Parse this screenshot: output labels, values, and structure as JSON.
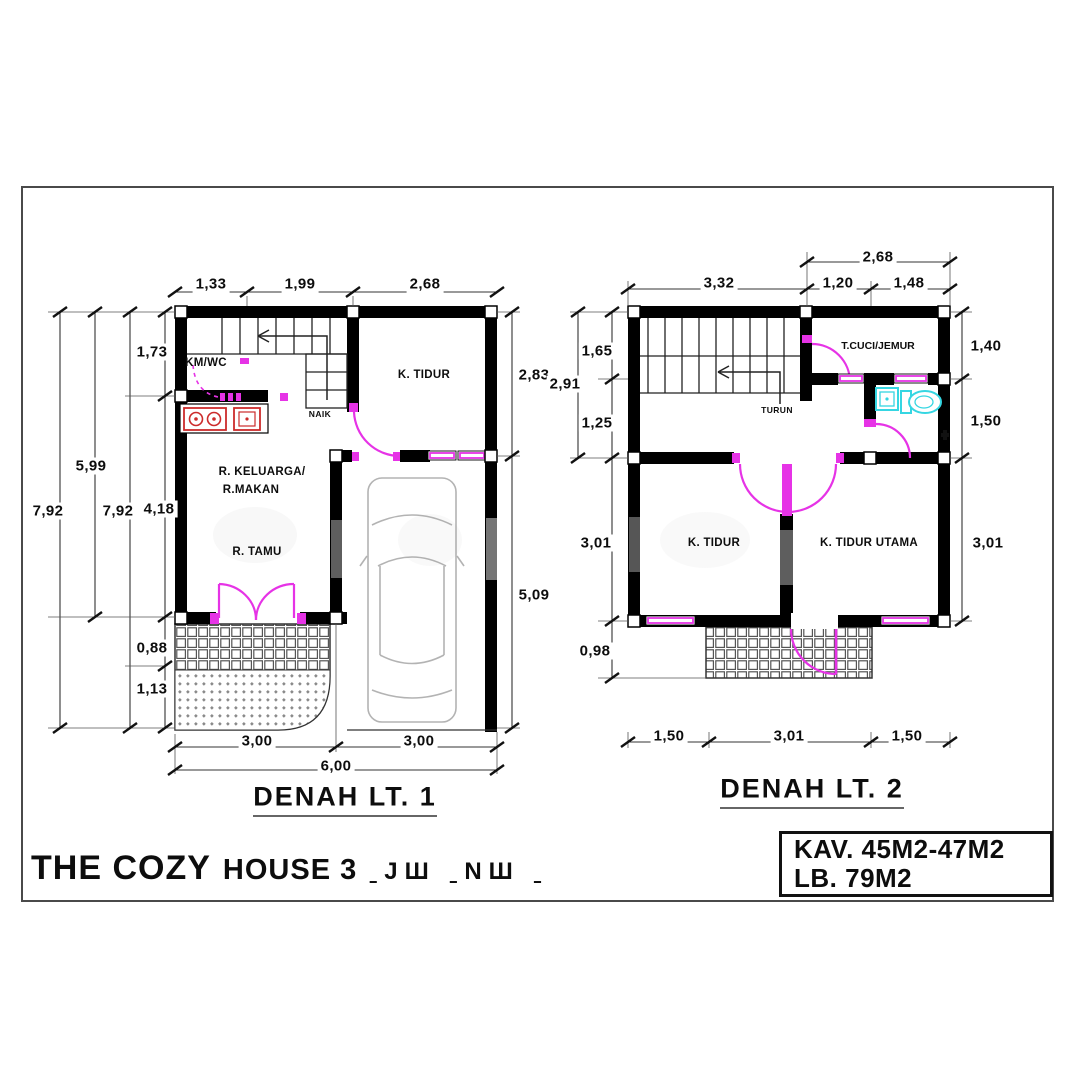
{
  "palette": {
    "wall": "#000000",
    "openings": "#e633e6",
    "sanitary": "#35d6e2",
    "kitchen": "#cc2b2b"
  },
  "plan1": {
    "title": "DENAH  LT. 1",
    "stair_direction": "NAIK",
    "rooms": {
      "kmwc": "KM/WC",
      "bedroom": "K. TIDUR",
      "family1": "R. KELUARGA/",
      "family2": "R.MAKAN",
      "living": "R. TAMU"
    },
    "dims": {
      "top": [
        "1,33",
        "1,99",
        "2,68"
      ],
      "left": [
        "1,73",
        "5,99",
        "7,92",
        "7,92",
        "4,18",
        "0,88",
        "1,13"
      ],
      "right": [
        "2,83",
        "5,09"
      ],
      "bottom": [
        "3,00",
        "3,00",
        "6,00"
      ]
    }
  },
  "plan2": {
    "title": "DENAH  LT. 2",
    "stair_direction": "TURUN",
    "rooms": {
      "laundry": "T.CUCI/JEMUR",
      "bedroom": "K. TIDUR",
      "master": "K. TIDUR UTAMA"
    },
    "dims": {
      "top": [
        "2,68",
        "3,32",
        "1,20",
        "1,48"
      ],
      "left": [
        "1,65",
        "2,91",
        "1,25",
        "3,01",
        "0,98"
      ],
      "right": [
        "1,40",
        "1,50",
        "3,01"
      ],
      "bottom": [
        "1,50",
        "3,01",
        "1,50"
      ]
    }
  },
  "footer": {
    "brand": "THE COZY",
    "brand2": "HOUSE 3",
    "brand_suffix": "ˍЈШ  ˍNШ  ˍ",
    "area_kav": "KAV. 45M2-47M2",
    "area_lb": "LB. 79M2"
  }
}
